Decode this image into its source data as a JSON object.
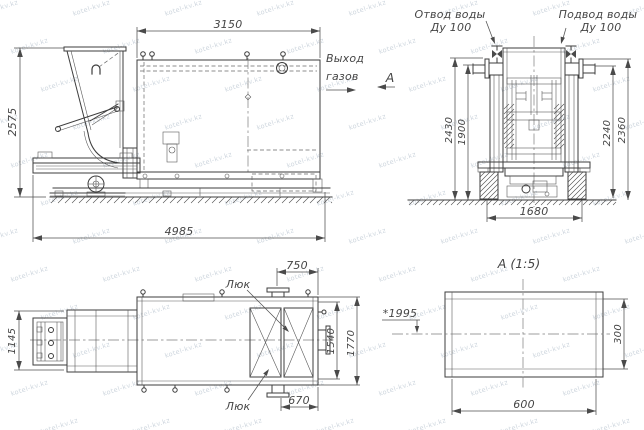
{
  "watermark": {
    "text": "kotel-kv.kz"
  },
  "colors": {
    "line": "#3d3d3d",
    "dim": "#4f4f4f",
    "text": "#454545",
    "background": "#ffffff",
    "watermark": "#9eaebd"
  },
  "views": {
    "side": {
      "dims": {
        "top": "3150",
        "left": "2575",
        "bottom": "4985"
      },
      "labels": {
        "gas_out1": "Выход",
        "gas_out2": "газов",
        "view_arrow": "А"
      }
    },
    "front": {
      "labels": {
        "outlet1": "Отвод воды",
        "outlet2": "Ду 100",
        "inlet1": "Подвод воды",
        "inlet2": "Ду 100"
      },
      "dims": {
        "h_outer_left": "2430",
        "h_inner_left": "1900",
        "h_inner_right": "2240",
        "h_outer_right": "2360",
        "base_width": "1680"
      }
    },
    "plan": {
      "labels": {
        "hatch_top": "Люк",
        "hatch_bottom": "Люк"
      },
      "dims": {
        "feeder_width": "1145",
        "hatch_offset_top": "750",
        "width_inner": "1540",
        "width_outer": "1770",
        "hatch_offset_bottom": "670",
        "height_mark": "*1995"
      }
    },
    "detail": {
      "title": "А (1:5)",
      "dims": {
        "width": "600",
        "height": "300"
      }
    }
  }
}
